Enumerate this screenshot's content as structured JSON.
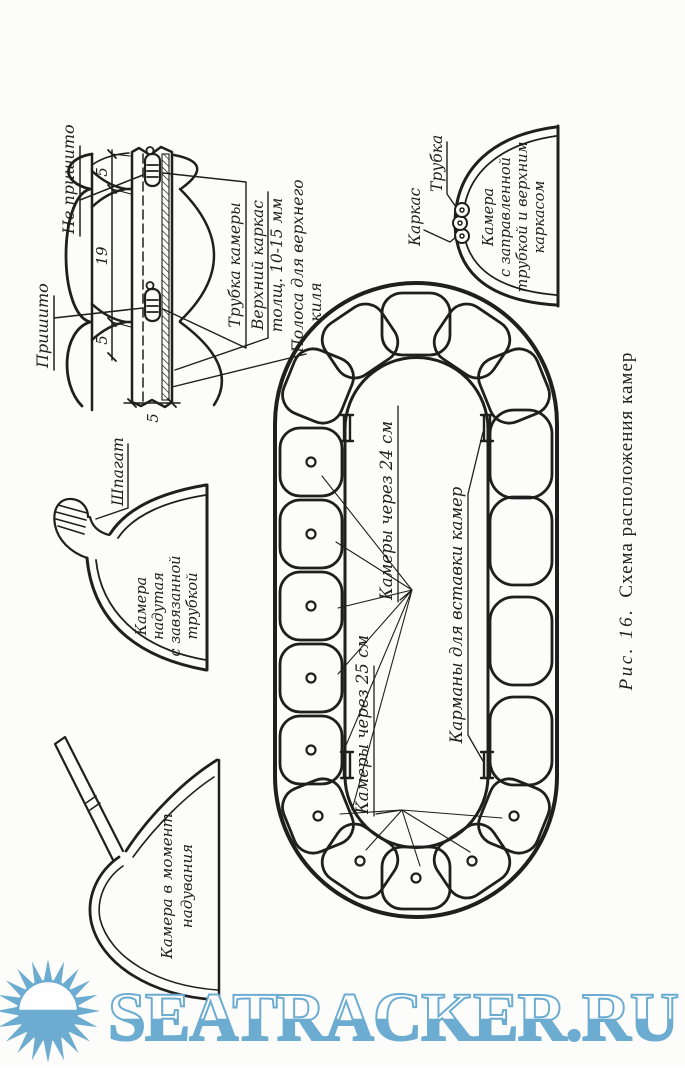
{
  "figure": {
    "caption": {
      "number": "Рис. 16.",
      "title": "Схема расположения камер"
    },
    "cross_section": {
      "sewn": "Пришито",
      "not_sewn": "Не пришито",
      "dims": {
        "right_5": "5",
        "mid_19": "19",
        "left_5": "5",
        "thickness_5": "5"
      },
      "tube_label": "Трубка камеры",
      "frame_label_1": "Верхний каркас",
      "frame_label_2": "толщ. 10-15 мм",
      "strip_label_1": "Полоса для верхнего",
      "strip_label_2": "киля"
    },
    "inflating": {
      "line1": "Камера в момент",
      "line2": "надувания"
    },
    "tied": {
      "twine": "Шпагат",
      "line1": "Камера",
      "line2": "надутая",
      "line3": "с завязанной",
      "line4": "трубкой"
    },
    "tucked": {
      "frame": "Каркас",
      "tube": "Трубка",
      "line1": "Камера",
      "line2": "с заправленной",
      "line3": "трубкой и верхним",
      "line4": "каркасом"
    },
    "plan": {
      "spacing24": "Камеры через 24 см",
      "spacing25": "Камеры через 25 см",
      "pockets": "Карманы для вставки камер"
    }
  },
  "watermark": {
    "text": "SEATRACKER.RU",
    "color": "#67a9d0"
  }
}
